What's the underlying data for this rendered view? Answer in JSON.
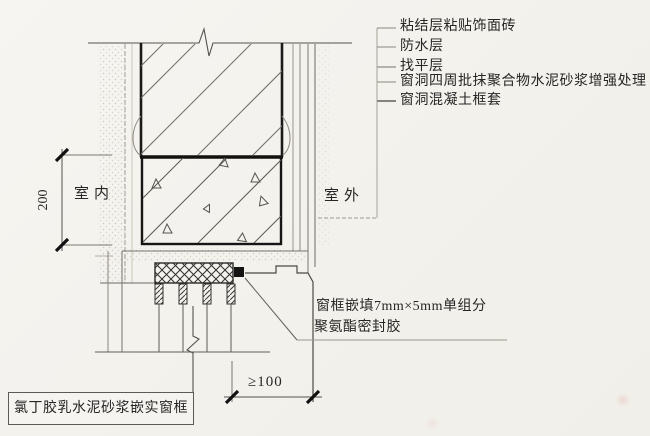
{
  "labels": {
    "right": [
      "粘结层粘贴饰面砖",
      "防水层",
      "找平层",
      "窗洞四周批抹聚合物水泥砂浆增强处理",
      "窗洞混凝土框套"
    ],
    "room_interior": "室内",
    "room_exterior": "室外",
    "sealant_line1": "窗框嵌填7mm×5mm单组分",
    "sealant_line2": "聚氨酯密封胶",
    "frame_bed": "氯丁胶乳水泥砂浆嵌实窗框"
  },
  "dimensions": {
    "vertical": "200",
    "horizontal": "≥100"
  },
  "colors": {
    "paper": "#f5f4f0",
    "ink": "#262626"
  }
}
